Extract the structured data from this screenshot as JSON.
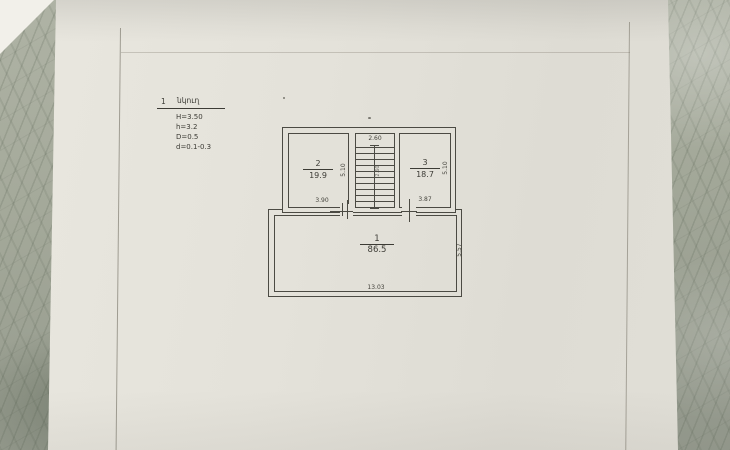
{
  "document": {
    "legend": {
      "item_number": "1",
      "item_title": "նկուղ",
      "specs": {
        "line1": "H=3.50",
        "line2": "h=3.2",
        "line3": "D=0.5",
        "line4": "d=0.1-0.3"
      }
    },
    "plan": {
      "rooms": [
        {
          "number": "2",
          "area": "19.9",
          "width": "3.90",
          "depth": "5.10"
        },
        {
          "number": "3",
          "area": "18.7",
          "width": "3.87",
          "depth": "5.10"
        },
        {
          "number": "1",
          "area": "86.5",
          "width": "13.03",
          "depth": "5.57"
        }
      ],
      "stair_opening_width": "2.60",
      "stair_note": "2.60"
    }
  },
  "colors": {
    "paper": "#e3e1d9",
    "marble_base": "#a3a899",
    "ink": "#4b4a43"
  }
}
